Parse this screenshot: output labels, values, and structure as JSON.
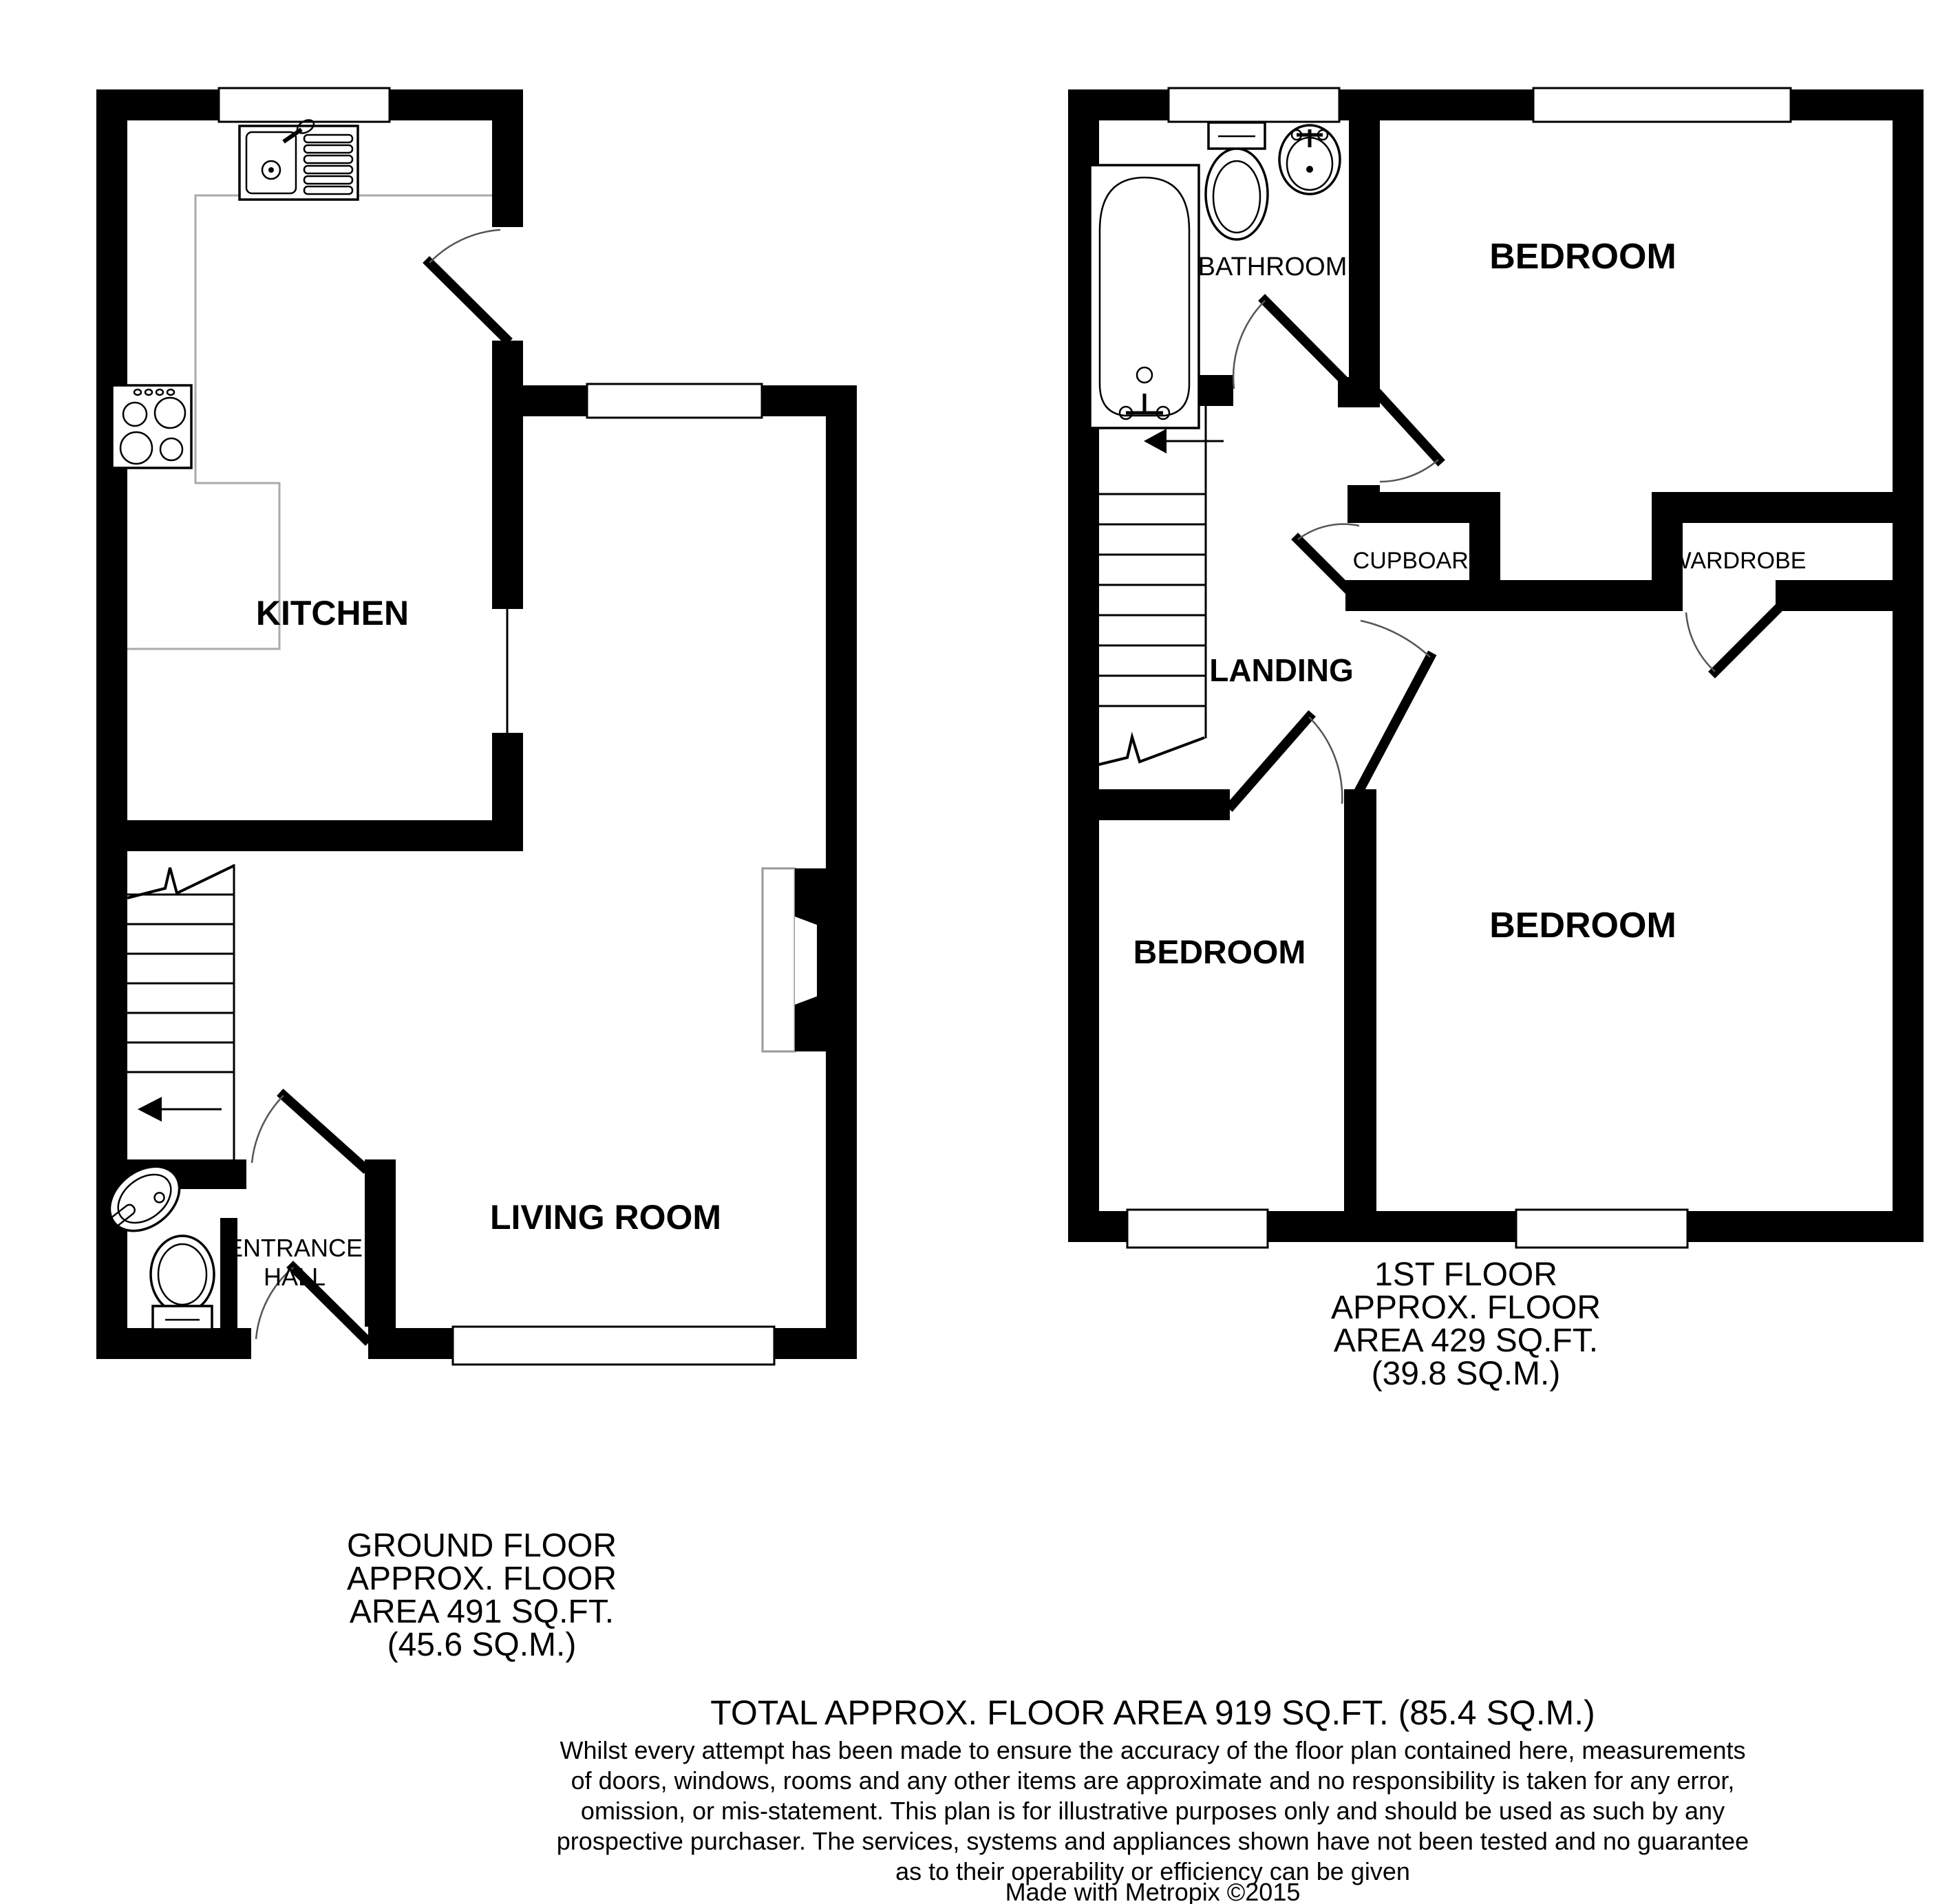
{
  "page": {
    "background": "#ffffff"
  },
  "colors": {
    "wall": "#000000",
    "window_frame": "#000000",
    "counter_line": "#aaaaaa",
    "door_arc": "#555555"
  },
  "ground_floor": {
    "labels": {
      "kitchen": "KITCHEN",
      "living_room": "LIVING ROOM",
      "entrance_line1": "ENTRANCE",
      "entrance_line2": "HALL"
    },
    "caption": [
      "GROUND FLOOR",
      "APPROX. FLOOR",
      "AREA 491 SQ.FT.",
      "(45.6 SQ.M.)"
    ],
    "fixtures": [
      "kitchen-sink-drainer",
      "cooker-hob",
      "staircase-up-arrow",
      "wc-toilet",
      "wc-corner-basin",
      "fireplace-chimney-breast",
      "front-door",
      "kitchen-door",
      "living-room-door",
      "windows"
    ]
  },
  "first_floor": {
    "labels": {
      "bathroom": "BATHROOM",
      "bedroom_top": "BEDROOM",
      "bedroom_left": "BEDROOM",
      "bedroom_right": "BEDROOM",
      "cupboard": "CUPBOARD",
      "wardrobe": "WARDROBE",
      "landing": "LANDING"
    },
    "caption": [
      "1ST FLOOR",
      "APPROX. FLOOR",
      "AREA 429 SQ.FT.",
      "(39.8 SQ.M.)"
    ],
    "fixtures": [
      "bath-tub",
      "toilet",
      "pedestal-basin",
      "staircase-down-arrow",
      "bathroom-door",
      "bedroom-doors",
      "cupboard-door",
      "wardrobe-door",
      "windows"
    ]
  },
  "summary": {
    "total": "TOTAL APPROX. FLOOR AREA 919 SQ.FT. (85.4 SQ.M.)",
    "disclaimer": [
      "Whilst every attempt has been made to ensure the accuracy of the floor plan contained here, measurements",
      "of doors, windows, rooms and any other items are approximate and no responsibility is taken for any error,",
      "omission, or mis-statement. This plan is for illustrative purposes only and should be used as such by any",
      "prospective purchaser. The services, systems and appliances shown have not been tested and no guarantee",
      "as to their operability or efficiency can be given"
    ],
    "credit": "Made with Metropix ©2015"
  }
}
